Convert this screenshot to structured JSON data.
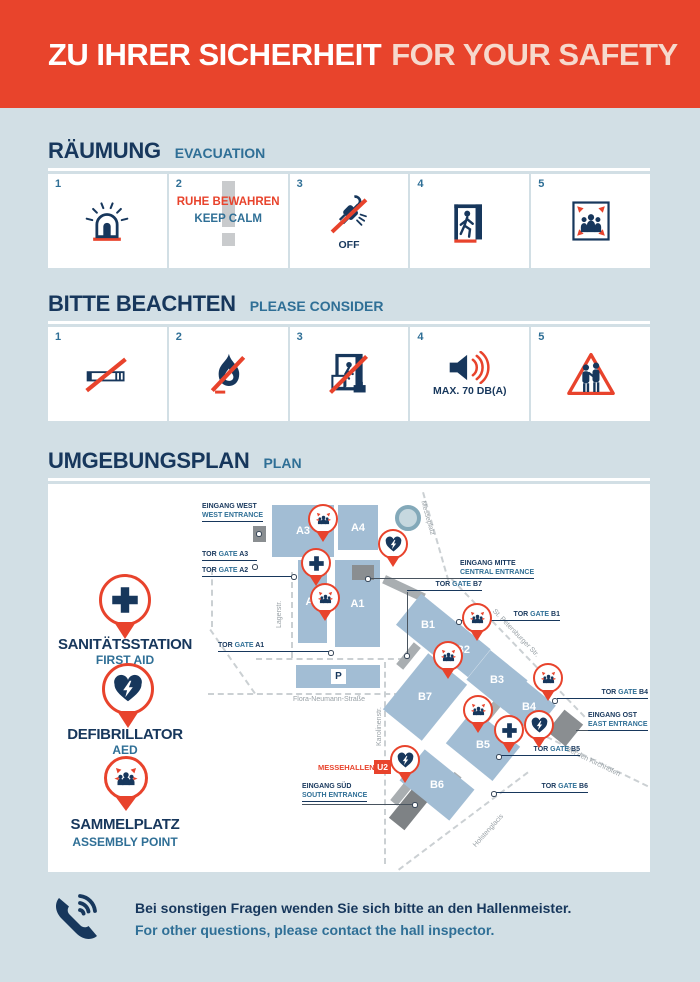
{
  "header": {
    "title_de": "ZU IHRER SICHERHEIT",
    "title_en": "FOR YOUR SAFETY"
  },
  "evacuation": {
    "title_de": "RÄUMUNG",
    "title_en": "EVACUATION",
    "steps": [
      {
        "num": "1",
        "icon": "alarm-icon"
      },
      {
        "num": "2",
        "icon": "keep-calm",
        "line_de": "RUHE BEWAHREN",
        "line_en": "KEEP CALM"
      },
      {
        "num": "3",
        "icon": "power-off-icon",
        "label": "OFF"
      },
      {
        "num": "4",
        "icon": "emergency-exit-icon"
      },
      {
        "num": "5",
        "icon": "assembly-point-icon"
      }
    ]
  },
  "consider": {
    "title_de": "BITTE BEACHTEN",
    "title_en": "PLEASE CONSIDER",
    "steps": [
      {
        "num": "1",
        "icon": "no-smoking-icon"
      },
      {
        "num": "2",
        "icon": "no-open-fire-icon"
      },
      {
        "num": "3",
        "icon": "no-blocking-exits-icon"
      },
      {
        "num": "4",
        "icon": "max-volume-icon",
        "label": "MAX. 70 DB(A)"
      },
      {
        "num": "5",
        "icon": "pickpocket-warning-icon"
      }
    ]
  },
  "plan": {
    "title_de": "UMGEBUNGSPLAN",
    "title_en": "PLAN",
    "legend": [
      {
        "de": "SANITÄTSSTATION",
        "en": "FIRST AID"
      },
      {
        "de": "DEFIBRILLATOR",
        "en": "AED"
      },
      {
        "de": "SAMMELPLATZ",
        "en": "ASSEMBLY  POINT"
      }
    ],
    "halls": {
      "a3": "A3",
      "a4": "A4",
      "a2": "A2",
      "a1": "A1",
      "b1": "B1",
      "b2": "B2",
      "b3": "B3",
      "b7": "B7",
      "b4": "B4",
      "b5": "B5",
      "b6": "B6"
    },
    "parking": "P",
    "entrances": {
      "west": {
        "de": "EINGANG WEST",
        "en": "WEST ENTRANCE"
      },
      "mitte": {
        "de": "EINGANG MITTE",
        "en": "CENTRAL ENTRANCE"
      },
      "ost": {
        "de": "EINGANG OST",
        "en": "EAST ENTRANCE"
      },
      "sued": {
        "de": "EINGANG SÜD",
        "en": "SOUTH ENTRANCE"
      }
    },
    "gates": {
      "a3": {
        "de": "TOR",
        "en": "GATE",
        "id": "A3"
      },
      "a2": {
        "de": "TOR",
        "en": "GATE",
        "id": "A2"
      },
      "a1": {
        "de": "TOR",
        "en": "GATE",
        "id": "A1"
      },
      "b7": {
        "de": "TOR",
        "en": "GATE",
        "id": "B7"
      },
      "b1": {
        "de": "TOR",
        "en": "GATE",
        "id": "B1"
      },
      "b4": {
        "de": "TOR",
        "en": "GATE",
        "id": "B4"
      },
      "b5": {
        "de": "TOR",
        "en": "GATE",
        "id": "B5"
      },
      "b6": {
        "de": "TOR",
        "en": "GATE",
        "id": "B6"
      }
    },
    "station": {
      "name": "MESSEHALLEN",
      "line": "U2"
    },
    "streets": {
      "lagerstr": "Lagerstr.",
      "messeplatz": "Messeplatz",
      "petersburger": "St. Petersburger Str.",
      "flora": "Flora-Neumann-Straße",
      "karolinen": "Karolinenstr.",
      "kirchhoefen": "Bei den Kirchhöfen",
      "holsten": "Holstenglacis"
    }
  },
  "footer": {
    "line_de": "Bei sonstigen Fragen wenden Sie sich bitte an den Hallenmeister.",
    "line_en": "For other questions, please contact the hall inspector."
  },
  "colors": {
    "red": "#E8432C",
    "navy": "#17375C",
    "blue": "#2F6F96",
    "background": "#D2DFE5",
    "hall": "#A2BDD4"
  }
}
